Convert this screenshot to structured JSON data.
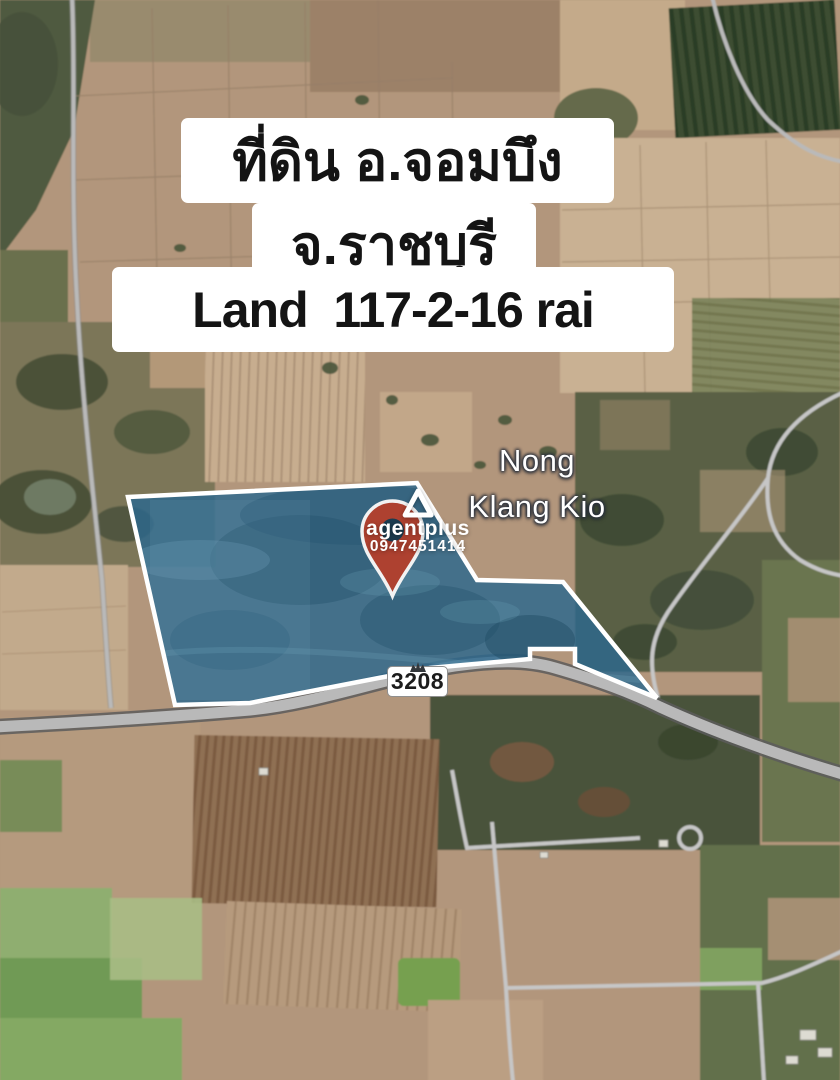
{
  "banner": {
    "line1": "ที่ดิน อ.จอมบึง",
    "line2": "จ.ราชบุรี",
    "line3": "Land  117-2-16 rai"
  },
  "map": {
    "place_label": {
      "line1": "Nong",
      "line2": "Klang Kio"
    },
    "route_badge": "3208"
  },
  "watermark": {
    "brand": "agentplus",
    "phone": "0947451414",
    "icon": "triangle-logo-icon"
  },
  "colors": {
    "plot_fill": "#2c688d",
    "plot_border": "#ffffff",
    "pin": "#ae4130",
    "pin_hole": "#1c3c50",
    "road_fill": "#b9b9b9",
    "banner_bg": "#ffffff",
    "banner_text": "#141414",
    "label_text": "#ffffff"
  }
}
